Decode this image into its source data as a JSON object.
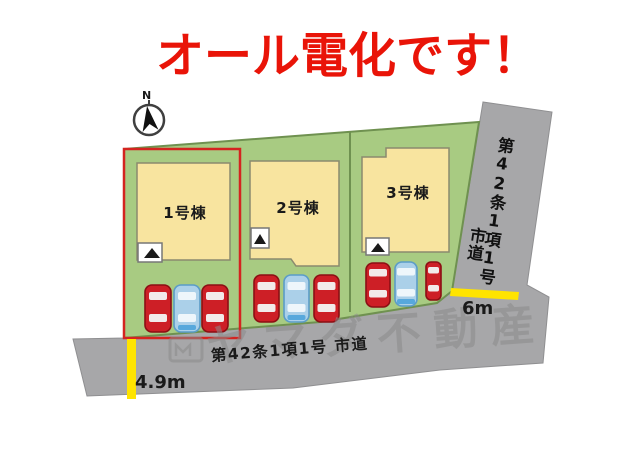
{
  "title": {
    "text": "オール電化です！",
    "color": "#e91408"
  },
  "compass": {
    "label": "N"
  },
  "palette": {
    "land": "#a8cb82",
    "land_stroke": "#6f9150",
    "road": "#a7a7a9",
    "road_stroke": "#8f8f91",
    "building": "#f8e49f",
    "building_stroke": "#8a8a6e",
    "highlight": "#d42420",
    "accent_yellow": "#ffe400",
    "divider": "#6f9150",
    "marker_bg": "#ffffff",
    "marker_stroke": "#777777",
    "marker_arrow": "#1a1a1a",
    "compass_stroke": "#3f3f3f",
    "compass_needle": "#111111"
  },
  "lots": [
    {
      "building_label": "1号棟",
      "highlighted": true,
      "cars": [
        "red",
        "blue",
        "red"
      ]
    },
    {
      "building_label": "2号棟",
      "highlighted": false,
      "cars": [
        "red",
        "blue",
        "red"
      ]
    },
    {
      "building_label": "3号棟",
      "highlighted": false,
      "cars": [
        "red",
        "blue",
        "red"
      ]
    }
  ],
  "car_colors": {
    "red": {
      "body": "#cd1f26",
      "stroke": "#8c0f14",
      "window": "#f2eaea"
    },
    "blue": {
      "body": "#abd0e9",
      "stroke": "#5b9cc7",
      "window": "#eef6fb",
      "bumper": "#57a8dc"
    }
  },
  "roads": {
    "right": {
      "label_column_1": "第42条1項1号",
      "label_column_2": "市道",
      "width_label": "6m"
    },
    "bottom": {
      "label": "第42条1項1号 市道",
      "width_label": "4.9m"
    }
  },
  "watermark": {
    "text": "ヤマダ不動産",
    "color": "#8b8b8b"
  }
}
